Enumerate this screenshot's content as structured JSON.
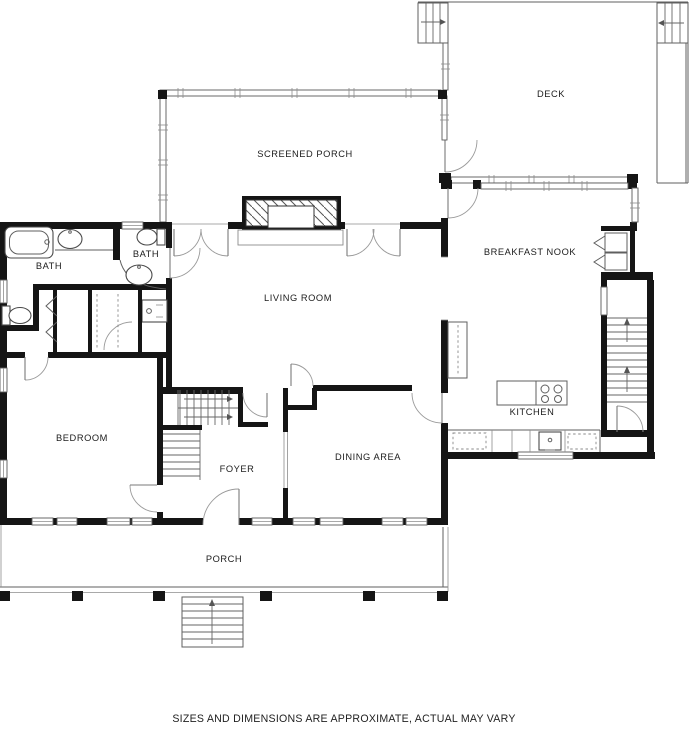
{
  "page": {
    "background": "#ffffff"
  },
  "plan": {
    "rooms": {
      "deck": "DECK",
      "screened_porch": "SCREENED PORCH",
      "breakfast_nook": "BREAKFAST NOOK",
      "bath_left": "BATH",
      "bath_right": "BATH",
      "living_room": "LIVING ROOM",
      "bedroom": "BEDROOM",
      "kitchen": "KITCHEN",
      "foyer": "FOYER",
      "dining_area": "DINING AREA",
      "porch": "PORCH"
    },
    "footer": "SIZES AND DIMENSIONS ARE APPROXIMATE, ACTUAL MAY VARY",
    "colors": {
      "page_bg": "#ffffff",
      "wall": "#151515",
      "label": "#1c1c1c"
    }
  }
}
